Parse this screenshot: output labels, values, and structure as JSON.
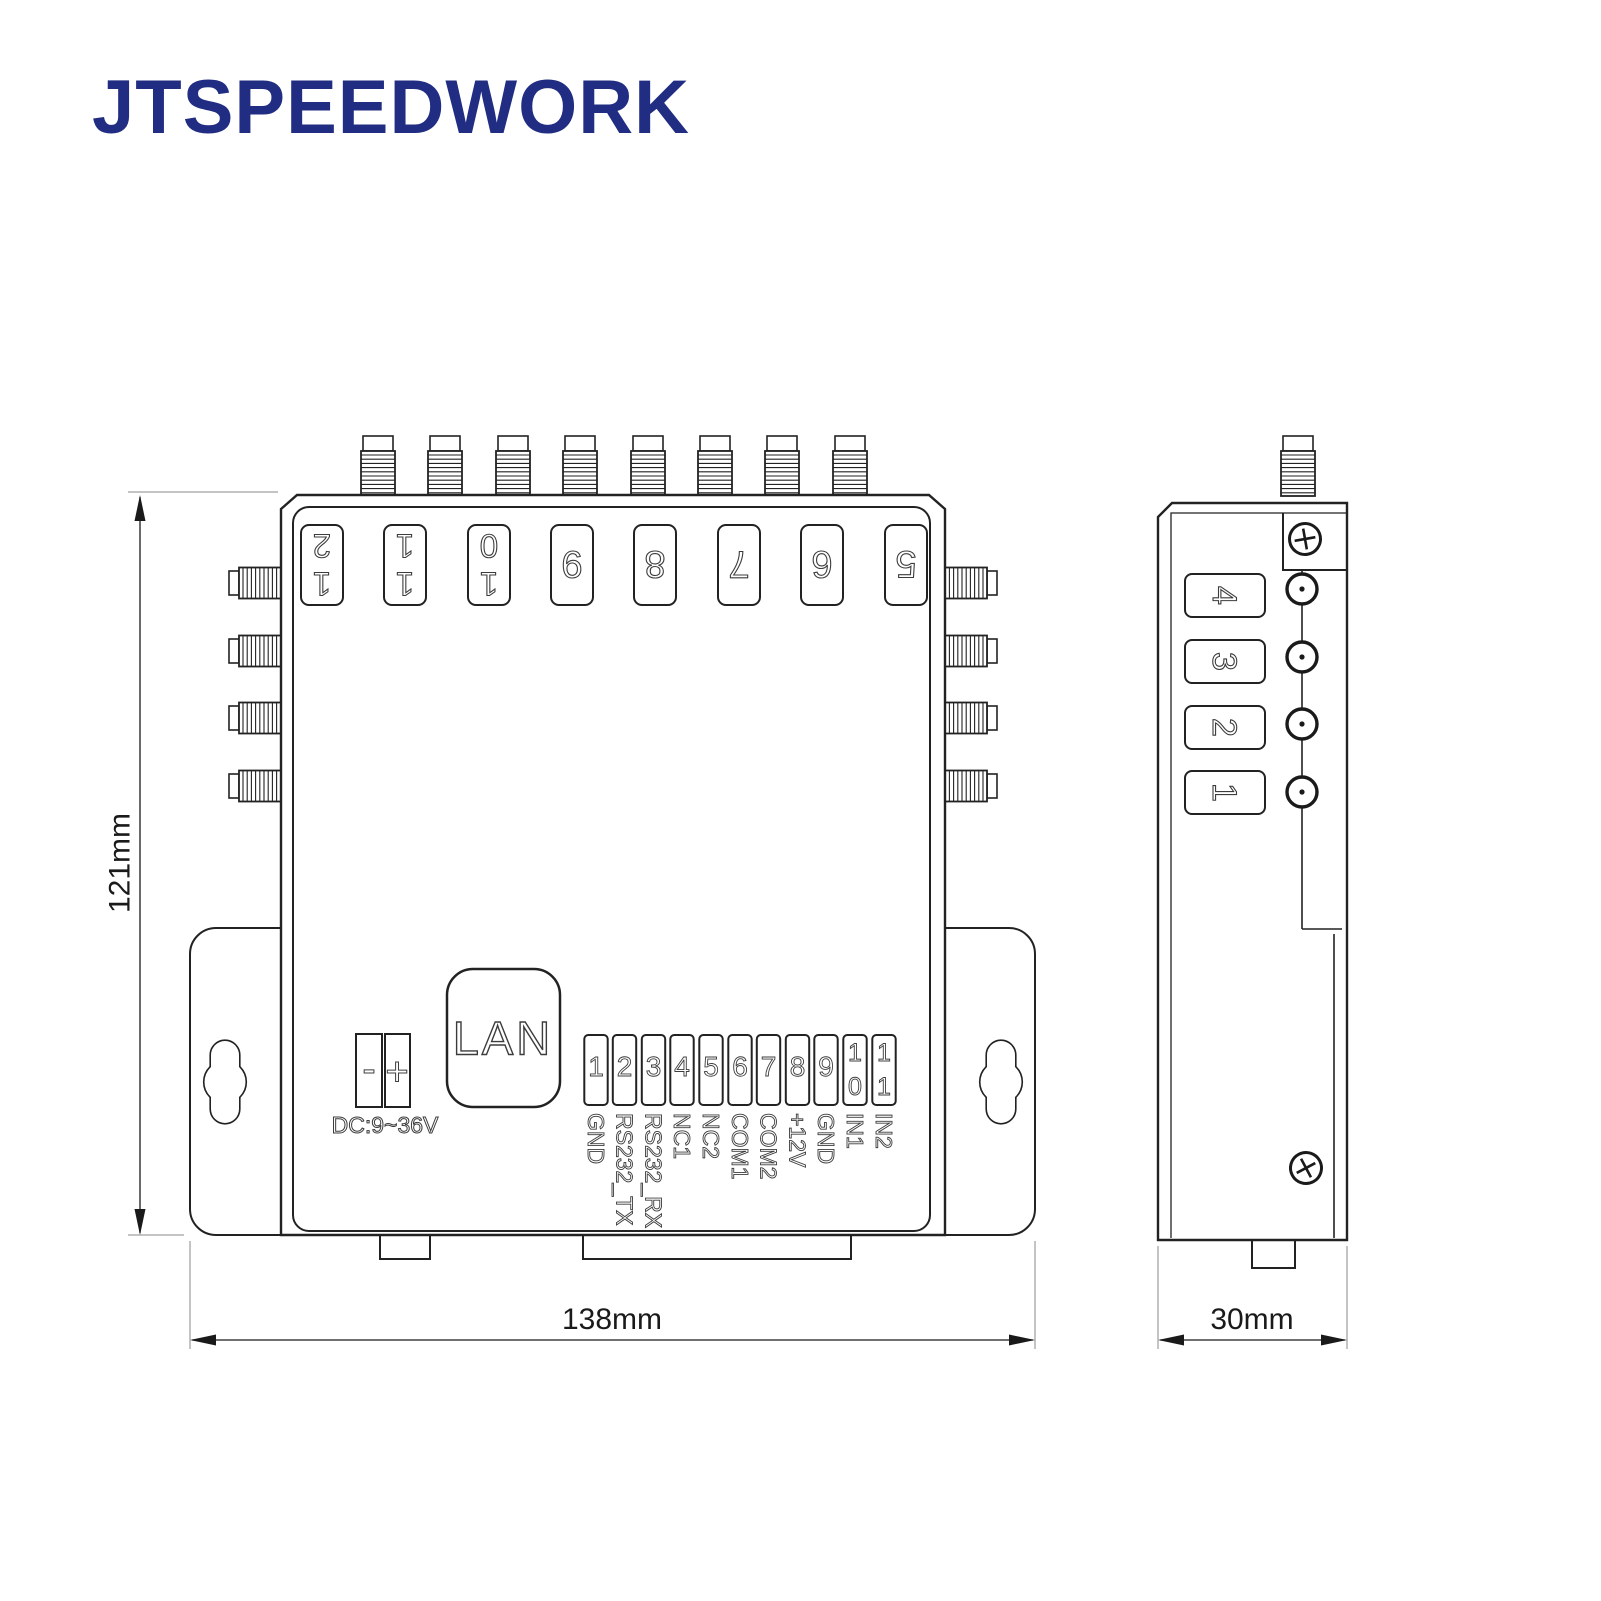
{
  "brand": {
    "logo_text": "JTSPEEDWORK",
    "logo_color": "#202d82"
  },
  "colors": {
    "line": "#222222",
    "dimension_text": "#1a1a1a",
    "background": "#ffffff"
  },
  "dimensions": {
    "height": "121mm",
    "width": "138mm",
    "depth": "30mm"
  },
  "front_view": {
    "top_ports": [
      {
        "num": "12",
        "digits": [
          "1",
          "2"
        ]
      },
      {
        "num": "11",
        "digits": [
          "1",
          "1"
        ]
      },
      {
        "num": "10",
        "digits": [
          "1",
          "0"
        ]
      },
      {
        "num": "9"
      },
      {
        "num": "8"
      },
      {
        "num": "7"
      },
      {
        "num": "6"
      },
      {
        "num": "5"
      }
    ],
    "power": {
      "label": "DC:9~36V",
      "minus": "-",
      "plus": "+"
    },
    "lan": {
      "label": "LAN"
    },
    "terminal": {
      "pins": [
        {
          "num": "1",
          "label": "GND"
        },
        {
          "num": "2",
          "label": "RS232_TX"
        },
        {
          "num": "3",
          "label": "RS232_RX"
        },
        {
          "num": "4",
          "label": "NC1"
        },
        {
          "num": "5",
          "label": "NC2"
        },
        {
          "num": "6",
          "label": "COM1"
        },
        {
          "num": "7",
          "label": "COM2"
        },
        {
          "num": "8",
          "label": "+12V"
        },
        {
          "num": "9",
          "label": "GND"
        },
        {
          "num": "10",
          "digits": [
            "1",
            "0"
          ],
          "label": "IN1"
        },
        {
          "num": "11",
          "digits": [
            "1",
            "1"
          ],
          "label": "IN2"
        }
      ]
    }
  },
  "side_view": {
    "ports": [
      "4",
      "3",
      "2",
      "1"
    ]
  }
}
